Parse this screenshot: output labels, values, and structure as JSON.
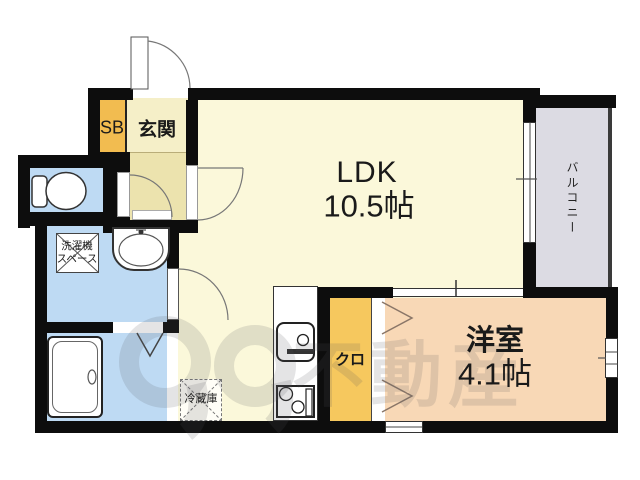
{
  "labels": {
    "entrance": "玄関",
    "shoe_box": "SB",
    "ldk_name": "LDK",
    "ldk_size": "10.5帖",
    "balcony": "バルコニー",
    "western_room": "洋室",
    "western_room_size": "4.1帖",
    "closet": "クロ",
    "refrigerator": "冷蔵庫",
    "washer_line1": "洗濯機",
    "washer_line2": "スペース",
    "watermark": "不動産"
  },
  "colors": {
    "ldk_floor": "#fbf8da",
    "entrance_floor": "#f5efc8",
    "hallway_floor": "#ece3ae",
    "western_floor": "#f8d8b6",
    "closet_fill": "#f6c85e",
    "shoebox_fill": "#f2bc50",
    "wet_area": "#bedaf3",
    "balcony_fill": "#dcdbe3",
    "wall": "#0d0d0d",
    "watermark": "rgba(90,85,95,0.16)"
  }
}
